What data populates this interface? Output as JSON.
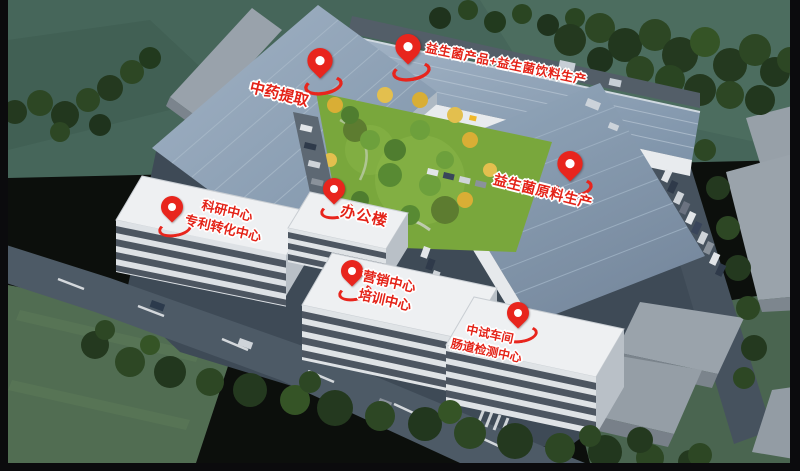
{
  "markers": [
    {
      "id": "herbal-extraction",
      "label_lines": [
        "中药提取"
      ]
    },
    {
      "id": "probiotic-products-beverage",
      "label_lines": [
        "益生菌产品+益生菌饮料生产"
      ]
    },
    {
      "id": "probiotic-raw-material",
      "label_lines": [
        "益生菌原料生产"
      ]
    },
    {
      "id": "research-patent-center",
      "label_lines": [
        "科研中心",
        "专利转化中心"
      ]
    },
    {
      "id": "office-building",
      "label_lines": [
        "办公楼"
      ]
    },
    {
      "id": "marketing-training-center",
      "label_lines": [
        "营销中心",
        "培训中心"
      ]
    },
    {
      "id": "pilot-plant-gut-testing",
      "label_lines": [
        "中试车间",
        "肠道检测中心"
      ]
    }
  ],
  "icons": {
    "pin": "location-pin-icon"
  },
  "colors": {
    "pin_red": "#e8251d",
    "label_text": "#e42318",
    "label_outline": "#ffffff",
    "roof_blue": "#8da2b6",
    "office_white": "#eef0f2",
    "window_band": "#39424e",
    "grass_green": "#79a73c",
    "field_green": "#46665a",
    "tree_green": "#2a4522",
    "road_gray": "#4d5a66",
    "border_black": "#0b0b0d"
  }
}
